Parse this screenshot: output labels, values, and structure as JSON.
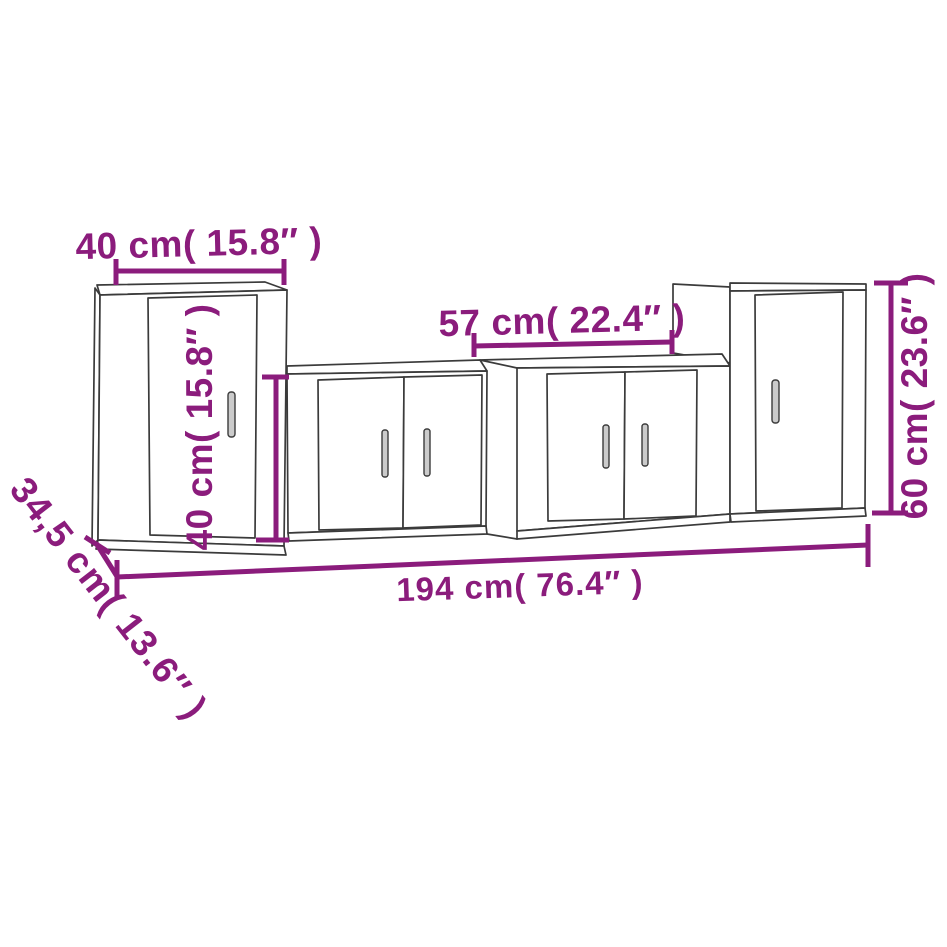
{
  "page": {
    "background_color": "#ffffff"
  },
  "diagram": {
    "description": "4-piece TV cabinet wall set dimension drawing",
    "accent_color": "#8B1C7C",
    "line_color": "#3b3b3b",
    "labels": {
      "top_width": "40 cm( 15.8″ )",
      "inner_height": "40 cm( 15.8″ )",
      "middle_width": "57 cm( 22.4″ )",
      "right_height": "60 cm( 23.6″ )",
      "total_width": "194 cm( 76.4″ )",
      "depth": "34,5 cm( 13.6″ )"
    },
    "dimensions": [
      {
        "part": "left-wall-cabinet-width",
        "cm": "40",
        "inch": "15.8"
      },
      {
        "part": "tv-bench-height",
        "cm": "40",
        "inch": "15.8"
      },
      {
        "part": "tv-bench-width",
        "cm": "57",
        "inch": "22.4"
      },
      {
        "part": "right-wall-cabinet-height",
        "cm": "60",
        "inch": "23.6"
      },
      {
        "part": "set-total-width",
        "cm": "194",
        "inch": "76.4"
      },
      {
        "part": "cabinet-depth",
        "cm": "34,5",
        "inch": "13.6"
      }
    ]
  }
}
